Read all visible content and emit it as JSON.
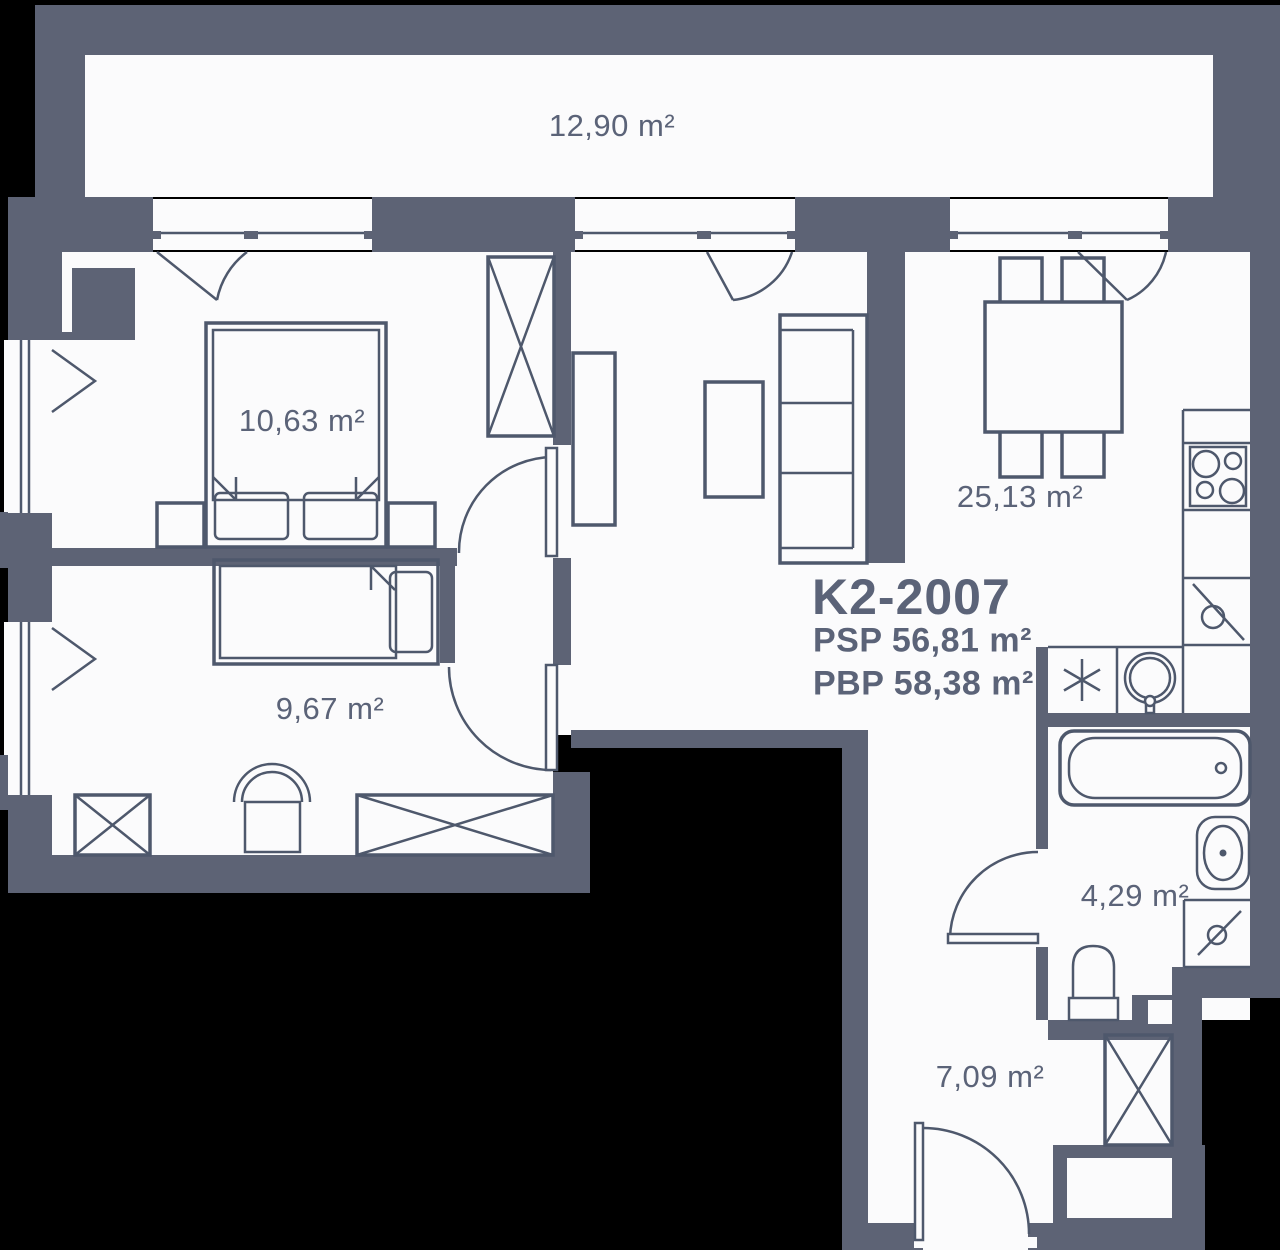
{
  "unit": {
    "code": "K2-2007",
    "psp": "PSP 56,81 m²",
    "pbp": "PBP 58,38 m²"
  },
  "rooms": {
    "balcony": "12,90 m²",
    "bedroom_1": "10,63 m²",
    "bedroom_2": "9,67 m²",
    "living_kitchen": "25,13 m²",
    "bathroom": "4,29 m²",
    "hallway": "7,09 m²"
  },
  "colors": {
    "wall": "#5d6375",
    "floor": "#fbfbfc",
    "line": "#4e586c",
    "text": "#5b6378",
    "background": "#000000"
  }
}
